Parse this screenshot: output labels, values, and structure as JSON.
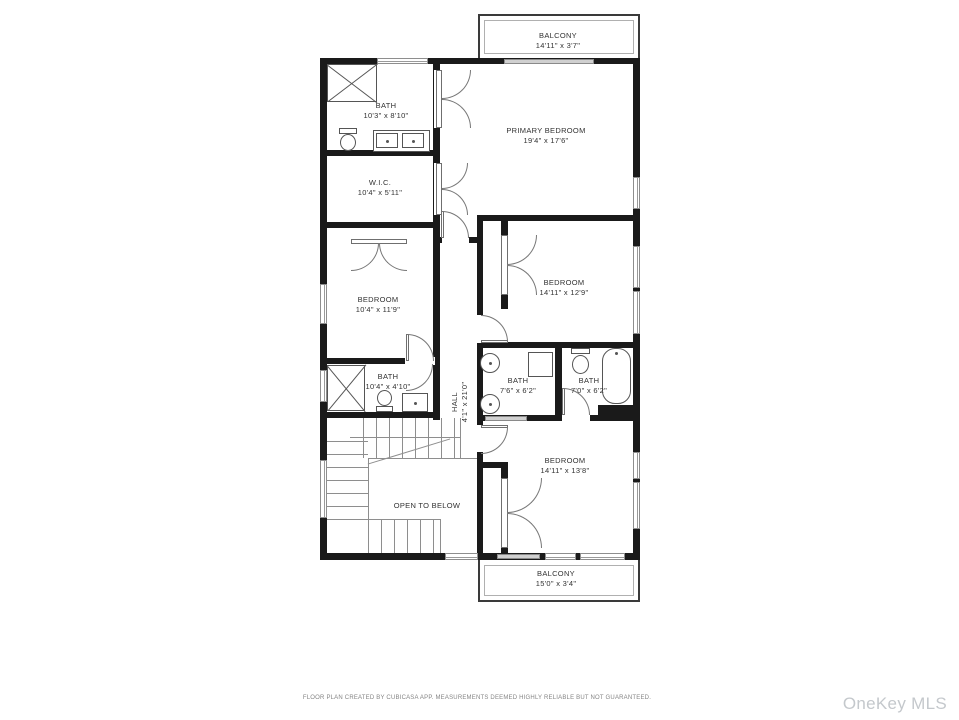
{
  "rooms": [
    {
      "id": "balcony-top",
      "name": "BALCONY",
      "dims": "14'11\" x 3'7\""
    },
    {
      "id": "bath-primary",
      "name": "BATH",
      "dims": "10'3\" x 8'10\""
    },
    {
      "id": "primary-bedroom",
      "name": "PRIMARY BEDROOM",
      "dims": "19'4\" x 17'6\""
    },
    {
      "id": "wic",
      "name": "W.I.C.",
      "dims": "10'4\" x 5'11\""
    },
    {
      "id": "bedroom-left",
      "name": "BEDROOM",
      "dims": "10'4\" x 11'9\""
    },
    {
      "id": "bedroom-mid",
      "name": "BEDROOM",
      "dims": "14'11\" x 12'9\""
    },
    {
      "id": "bath-hall",
      "name": "BATH",
      "dims": "7'6\" x 6'2\""
    },
    {
      "id": "bath-ensuite",
      "name": "BATH",
      "dims": "7'0\" x 6'2\""
    },
    {
      "id": "bath-lower",
      "name": "BATH",
      "dims": "10'4\" x 4'10\""
    },
    {
      "id": "hall",
      "name": "HALL",
      "dims": "4'1\" x 21'0\""
    },
    {
      "id": "bedroom-bottom",
      "name": "BEDROOM",
      "dims": "14'11\" x 13'8\""
    },
    {
      "id": "open-below",
      "name": "OPEN TO BELOW",
      "dims": ""
    },
    {
      "id": "balcony-bottom",
      "name": "BALCONY",
      "dims": "15'0\" x 3'4\""
    }
  ],
  "footer": "FLOOR PLAN CREATED BY CUBICASA APP. MEASUREMENTS DEEMED HIGHLY RELIABLE BUT NOT GUARANTEED.",
  "watermark": "OneKey MLS",
  "colors": {
    "wall": "#1a1a1a",
    "thin_line": "#8e8e8e",
    "text": "#323232",
    "watermark": "#c4c8cc"
  }
}
